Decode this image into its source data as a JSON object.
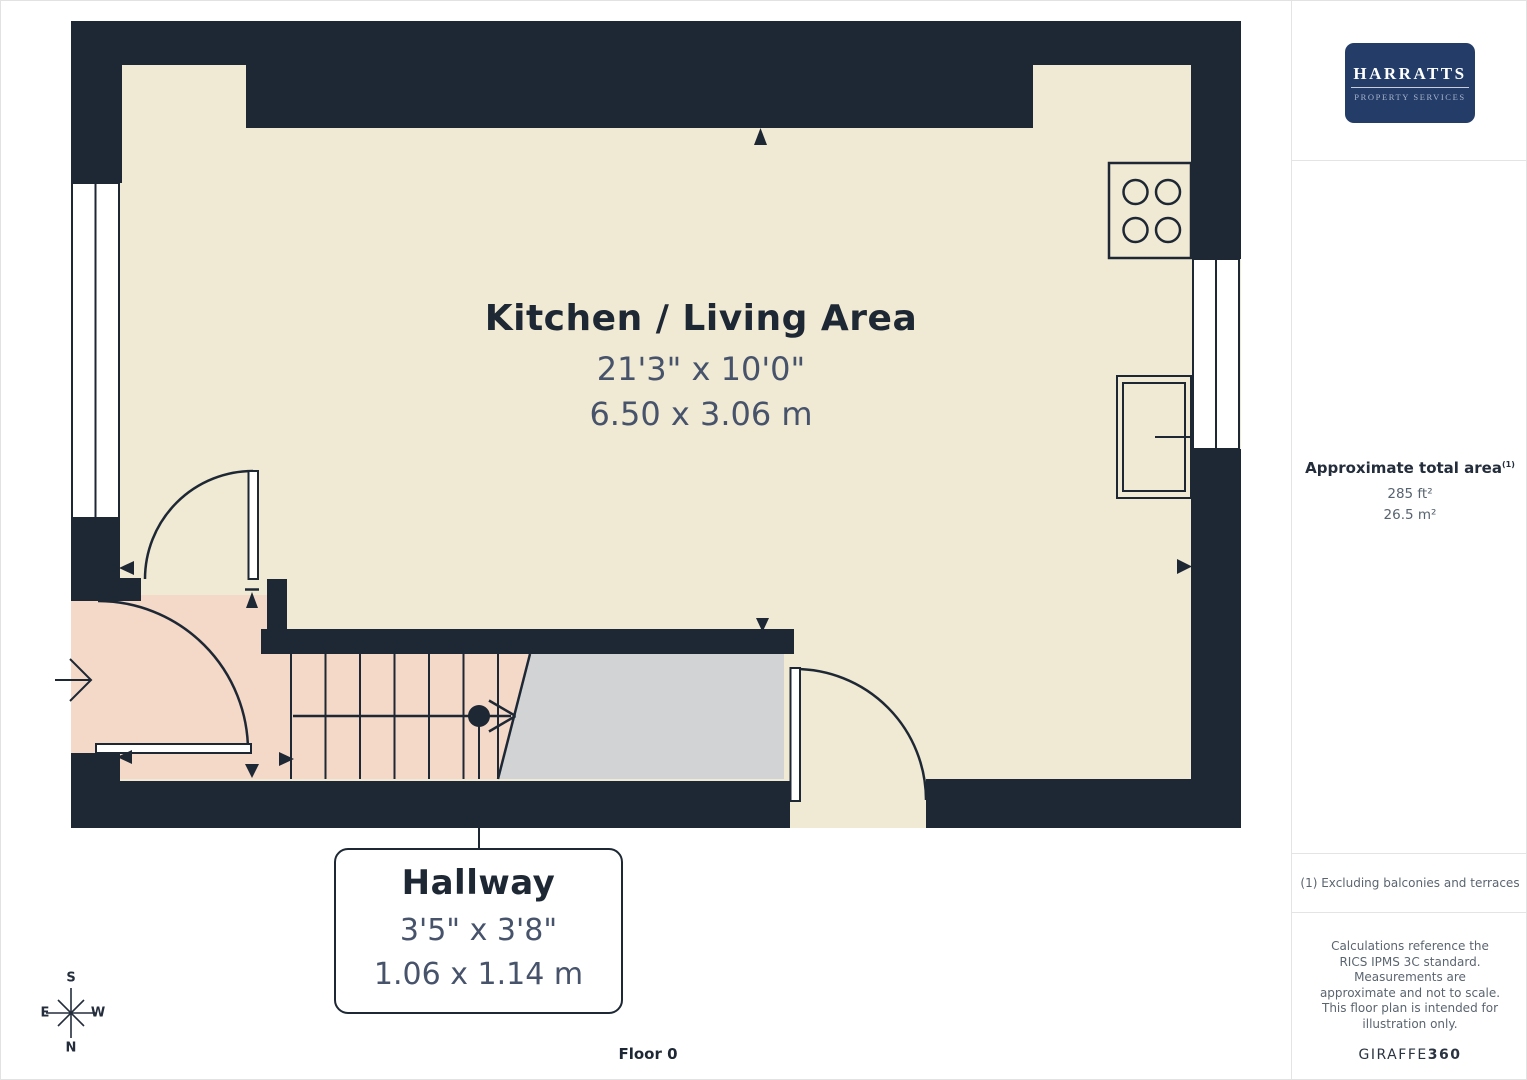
{
  "plan": {
    "kitchen": {
      "name": "Kitchen / Living Area",
      "dims_imperial": "21'3\" x 10'0\"",
      "dims_metric": "6.50 x 3.06 m"
    },
    "hallway": {
      "name": "Hallway",
      "dims_imperial": "3'5\" x 3'8\"",
      "dims_metric": "1.06 x 1.14 m"
    },
    "floor_label": "Floor 0",
    "compass": {
      "north": "N",
      "south": "S",
      "east": "E",
      "west": "W"
    }
  },
  "sidebar": {
    "logo": {
      "name": "HARRATTS",
      "tagline": "PROPERTY SERVICES"
    },
    "area_summary": {
      "heading": "Approximate total area",
      "footnote_ref": "(1)",
      "imperial": "285 ft²",
      "metric": "26.5 m²"
    },
    "footnote": "(1) Excluding balconies and terraces",
    "disclaimer": "Calculations reference the RICS IPMS 3C standard. Measurements are approximate and not to scale. This floor plan is intended for illustration only.",
    "brand": {
      "name": "GIRAFFE",
      "suffix": "360"
    }
  },
  "colors": {
    "wall": "#1e2834",
    "room_cream": "#f0e9d3",
    "hallway_pink": "#f4d8c8",
    "stair_gray": "#d2d3d5",
    "logo_navy": "#233c68",
    "dims_text": "#46536b",
    "muted_text": "#5b6570"
  }
}
